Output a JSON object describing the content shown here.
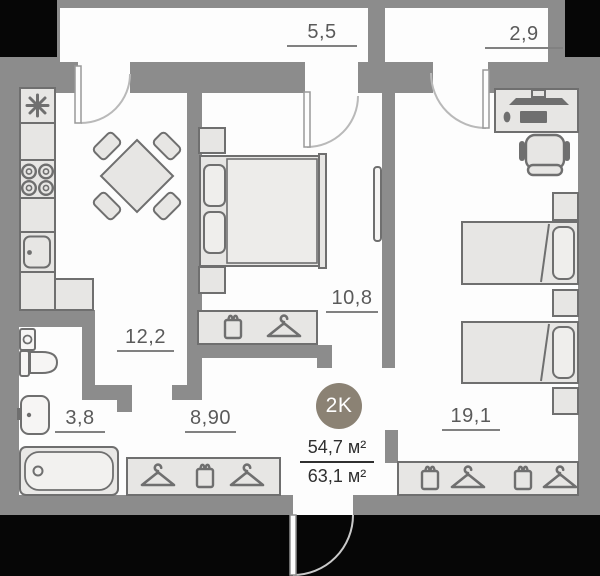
{
  "plan": {
    "badge": "2K",
    "area_upper": "54,7 м²",
    "area_lower": "63,1 м²",
    "labels": {
      "balcony_1": "5,5",
      "balcony_2": "2,9",
      "kitchen": "12,2",
      "bedroom_1": "10,8",
      "bathroom": "3,8",
      "hallway": "8,90",
      "bedroom_2": "19,1"
    },
    "colors": {
      "badge_bg": "#8b8274",
      "wall": "#8c8c8c",
      "floor": "#fdfdfd",
      "outside": "#060606",
      "furniture_fill": "#e7e6e4",
      "furniture_stroke": "#6f6f6f",
      "label_text": "#5a5a5a",
      "area_text": "#2f2f2f"
    }
  }
}
